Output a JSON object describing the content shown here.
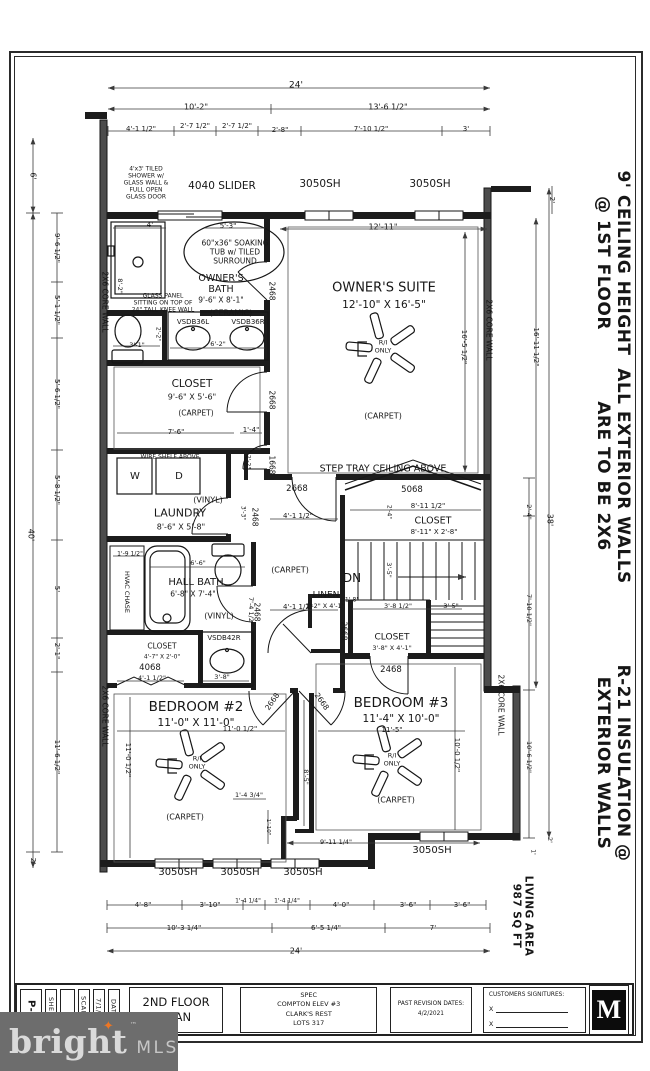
{
  "title_block": {
    "sheet_value": "P-4",
    "sheet_label": "SHEET:",
    "scale_label": "SCALE:",
    "date_value": "7/1/20",
    "date_label": "DATE:",
    "plan_title": "2ND FLOOR\nPLAN",
    "project": "SPEC\nCOMPTON ELEV #3\nCLARK'S REST\nLOTS 317",
    "revision_label": "PAST REVISION DATES:",
    "revision_value": "4/2/2021",
    "signatures_label": "CUSTOMERS SIGNITURES:",
    "sig_mark": "X",
    "logo_letter": "M"
  },
  "watermark": {
    "brand": "bright",
    "tm": "™",
    "suffix": "MLS",
    "star_color": "#ee7623"
  },
  "plan": {
    "labels": [
      {
        "n": "dim-overall-width-top",
        "t": "24'",
        "x": 296,
        "y": 86,
        "s": 9
      },
      {
        "n": "dim-10-2",
        "t": "10'-2\"",
        "x": 196,
        "y": 107,
        "s": 8
      },
      {
        "n": "dim-13-6-half",
        "t": "13'-6 1/2\"",
        "x": 388,
        "y": 107,
        "s": 8
      },
      {
        "n": "dim-4-1-half-top",
        "t": "4'-1 1/2\"",
        "x": 141,
        "y": 129,
        "s": 7
      },
      {
        "n": "dim-2-7-half-a",
        "t": "2'-7 1/2\"",
        "x": 195,
        "y": 126,
        "s": 7
      },
      {
        "n": "dim-2-7-half-b",
        "t": "2'-7 1/2\"",
        "x": 237,
        "y": 126,
        "s": 7
      },
      {
        "n": "dim-2-8",
        "t": "2'-8\"",
        "x": 280,
        "y": 130,
        "s": 7
      },
      {
        "n": "dim-7-10-half-top",
        "t": "7'-10 1/2\"",
        "x": 371,
        "y": 129,
        "s": 7
      },
      {
        "n": "dim-3ft-top",
        "t": "3'",
        "x": 466,
        "y": 129,
        "s": 7
      },
      {
        "n": "window-4040-slider",
        "t": "4040 SLIDER",
        "x": 222,
        "y": 186,
        "s": 10.5
      },
      {
        "n": "window-3050sh-top-a",
        "t": "3050SH",
        "x": 320,
        "y": 184,
        "s": 10.5
      },
      {
        "n": "window-3050sh-top-b",
        "t": "3050SH",
        "x": 430,
        "y": 184,
        "s": 10.5
      },
      {
        "n": "dim-12-11",
        "t": "12'-11\"",
        "x": 383,
        "y": 227,
        "s": 8
      },
      {
        "n": "dim-6ft-left",
        "t": "6'",
        "x": 33,
        "y": 176,
        "s": 8,
        "r": 90
      },
      {
        "n": "dim-9-6-half-left",
        "t": "9'-6 1/2\"",
        "x": 57,
        "y": 248,
        "s": 7,
        "r": 90
      },
      {
        "n": "dim-5-1-half-left",
        "t": "5'-1 1/2\"",
        "x": 57,
        "y": 310,
        "s": 7,
        "r": 90
      },
      {
        "n": "dim-5-6-half-left",
        "t": "5'-6 1/2\"",
        "x": 57,
        "y": 394,
        "s": 7,
        "r": 90
      },
      {
        "n": "dim-5-8-half-left",
        "t": "5'-8 1/2\"",
        "x": 57,
        "y": 490,
        "s": 7,
        "r": 90
      },
      {
        "n": "dim-40ft-left",
        "t": "40'",
        "x": 31,
        "y": 535,
        "s": 8,
        "r": 90
      },
      {
        "n": "dim-5ft-left",
        "t": "5'",
        "x": 57,
        "y": 589,
        "s": 7,
        "r": 90
      },
      {
        "n": "dim-2-1-left",
        "t": "2'-1\"",
        "x": 57,
        "y": 651,
        "s": 7,
        "r": 90
      },
      {
        "n": "dim-11-6-half-left",
        "t": "11'-6 1/2\"",
        "x": 57,
        "y": 757,
        "s": 7,
        "r": 90
      },
      {
        "n": "dim-2ft-left-bottom",
        "t": "2'",
        "x": 33,
        "y": 861,
        "s": 7,
        "r": 90
      },
      {
        "n": "core-wall-left-upper",
        "t": "2X6 CORE WALL",
        "x": 104,
        "y": 302,
        "s": 7.5,
        "r": 90
      },
      {
        "n": "core-wall-left-lower",
        "t": "2X6 CORE WALL",
        "x": 104,
        "y": 716,
        "s": 7.5,
        "r": 90
      },
      {
        "n": "core-wall-right-upper",
        "t": "2X6 CORE WALL",
        "x": 488,
        "y": 330,
        "s": 7.5,
        "r": 90
      },
      {
        "n": "core-wall-right-lower",
        "t": "2X6 CORE WALL",
        "x": 500,
        "y": 705,
        "s": 7.5,
        "r": 90
      },
      {
        "n": "note-tiled-shower",
        "t": "4'x3' TILED\nSHOWER w/\nGLASS WALL &\nFULL OPEN\nGLASS DOOR",
        "x": 146,
        "y": 183,
        "s": 6
      },
      {
        "n": "dim-4ft-shower",
        "t": "4'",
        "x": 150,
        "y": 225,
        "s": 7
      },
      {
        "n": "dim-5-3-tub",
        "t": "5'-3\"",
        "x": 228,
        "y": 226,
        "s": 7
      },
      {
        "n": "note-soaking-tub",
        "t": "60\"x36\" SOAKING\nTUB w/ TILED\nSURROUND",
        "x": 235,
        "y": 253,
        "s": 7.5
      },
      {
        "n": "room-owners-bath",
        "t": "OWNER'S\nBATH",
        "x": 221,
        "y": 284,
        "s": 9.5
      },
      {
        "n": "dim-owners-bath",
        "t": "9'-6\" X 8'-1\"",
        "x": 221,
        "y": 301,
        "s": 7.5
      },
      {
        "n": "finish-owners-bath",
        "t": "(CERAMIC)",
        "x": 231,
        "y": 313,
        "s": 8
      },
      {
        "n": "dim-8-2-shower",
        "t": "8'-2\"",
        "x": 119,
        "y": 286,
        "s": 6.5,
        "r": 90
      },
      {
        "n": "note-glass-panel",
        "t": "GLASS PANEL\nSITTING ON TOP OF\n24\" TALL KNEE WALL",
        "x": 163,
        "y": 303,
        "s": 6
      },
      {
        "n": "door-2468-owners-bath",
        "t": "2468",
        "x": 271,
        "y": 291,
        "s": 7.5,
        "r": 90
      },
      {
        "n": "vanity-vsdb36l",
        "t": "VSDB36L",
        "x": 193,
        "y": 322,
        "s": 7
      },
      {
        "n": "vanity-vsdb36r",
        "t": "VSDB36R",
        "x": 248,
        "y": 322,
        "s": 7
      },
      {
        "n": "dim-2-2-toilet",
        "t": "2'-2\"",
        "x": 158,
        "y": 334,
        "s": 6,
        "r": 90
      },
      {
        "n": "dim-3-1-toilet",
        "t": "3'-1\"",
        "x": 137,
        "y": 346,
        "s": 6.5
      },
      {
        "n": "dim-6-2-vanity",
        "t": "6'-2\"",
        "x": 218,
        "y": 345,
        "s": 6.5
      },
      {
        "n": "room-owners-suite",
        "t": "OWNER'S SUITE",
        "x": 384,
        "y": 288,
        "s": 13
      },
      {
        "n": "dim-owners-suite",
        "t": "12'-10\" X 16'-5\"",
        "x": 384,
        "y": 305,
        "s": 10.5
      },
      {
        "n": "fan-owners-suite-label",
        "t": "R/I\nONLY",
        "x": 383,
        "y": 347,
        "s": 6.5
      },
      {
        "n": "finish-owners-suite",
        "t": "(CARPET)",
        "x": 383,
        "y": 416,
        "s": 8
      },
      {
        "n": "note-step-tray",
        "t": "STEP TRAY CEILING ABOVE",
        "x": 383,
        "y": 469,
        "s": 9.5
      },
      {
        "n": "dim-16-5-half-suite",
        "t": "16'-5 1/2\"",
        "x": 464,
        "y": 347,
        "s": 7,
        "r": 90
      },
      {
        "n": "dim-16-11-half-right",
        "t": "16'-11 1/2\"",
        "x": 536,
        "y": 347,
        "s": 7,
        "r": 90
      },
      {
        "n": "dim-2ft-right-top",
        "t": "2'",
        "x": 552,
        "y": 200,
        "s": 7,
        "r": 90
      },
      {
        "n": "dim-38ft-right",
        "t": "38'",
        "x": 550,
        "y": 520,
        "s": 8,
        "r": 90
      },
      {
        "n": "room-owners-closet",
        "t": "CLOSET",
        "x": 192,
        "y": 384,
        "s": 10.5
      },
      {
        "n": "dim-owners-closet",
        "t": "9'-6\" X 5'-6\"",
        "x": 192,
        "y": 397,
        "s": 8
      },
      {
        "n": "finish-owners-closet",
        "t": "(CARPET)",
        "x": 196,
        "y": 414,
        "s": 7.5
      },
      {
        "n": "dim-7-6-closet",
        "t": "7'-6\"",
        "x": 176,
        "y": 432,
        "s": 7
      },
      {
        "n": "dim-1-4-closet",
        "t": "1'-4\"",
        "x": 251,
        "y": 430,
        "s": 7
      },
      {
        "n": "door-2668-owners-closet",
        "t": "2668",
        "x": 271,
        "y": 400,
        "s": 7.5,
        "r": 90
      },
      {
        "n": "door-1668-hall",
        "t": "1668",
        "x": 271,
        "y": 465,
        "s": 7.5,
        "r": 90
      },
      {
        "n": "dim-2-2-alcove",
        "t": "2'-2\"",
        "x": 248,
        "y": 462,
        "s": 6,
        "r": 90
      },
      {
        "n": "note-wire-shelf",
        "t": "WIRE SHELF ABOVE",
        "x": 170,
        "y": 457,
        "s": 6
      },
      {
        "n": "appliance-washer",
        "t": "W",
        "x": 135,
        "y": 477,
        "s": 10
      },
      {
        "n": "appliance-dryer",
        "t": "D",
        "x": 179,
        "y": 477,
        "s": 10
      },
      {
        "n": "finish-laundry",
        "t": "(VINYL)",
        "x": 208,
        "y": 500,
        "s": 8
      },
      {
        "n": "room-laundry",
        "t": "LAUNDRY",
        "x": 180,
        "y": 514,
        "s": 11
      },
      {
        "n": "dim-laundry",
        "t": "8'-6\" X 5'-8\"",
        "x": 181,
        "y": 527,
        "s": 8
      },
      {
        "n": "door-2468-laundry",
        "t": "2468",
        "x": 254,
        "y": 517,
        "s": 7.5,
        "r": 90
      },
      {
        "n": "dim-3-3-laundry",
        "t": "3'-3\"",
        "x": 243,
        "y": 513,
        "s": 6,
        "r": 90
      },
      {
        "n": "door-2668-suite-entry",
        "t": "2668",
        "x": 297,
        "y": 489,
        "s": 8.5
      },
      {
        "n": "dim-4-1-half-hall-top",
        "t": "4'-1 1/2\"",
        "x": 298,
        "y": 516,
        "s": 7
      },
      {
        "n": "finish-hall",
        "t": "(CARPET)",
        "x": 290,
        "y": 570,
        "s": 8
      },
      {
        "n": "dim-4-1-half-hall-bottom",
        "t": "4'-1 1/2\"",
        "x": 298,
        "y": 607,
        "s": 7
      },
      {
        "n": "dim-7-4-half-hall",
        "t": "7'-4 1/2\"",
        "x": 250,
        "y": 611,
        "s": 6.5,
        "r": 90
      },
      {
        "n": "window-5068",
        "t": "5068",
        "x": 412,
        "y": 490,
        "s": 8.5
      },
      {
        "n": "dim-8-11-half-stairs",
        "t": "8'-11 1/2\"",
        "x": 428,
        "y": 506,
        "s": 7
      },
      {
        "n": "dim-2-4-stairs",
        "t": "2'-4\"",
        "x": 389,
        "y": 512,
        "s": 6,
        "r": 90
      },
      {
        "n": "room-stairs-closet",
        "t": "CLOSET",
        "x": 433,
        "y": 521,
        "s": 9.5
      },
      {
        "n": "dim-stairs-closet",
        "t": "8'-11\" X 2'-8\"",
        "x": 434,
        "y": 532,
        "s": 7
      },
      {
        "n": "stairs-dn",
        "t": "DN",
        "x": 352,
        "y": 578,
        "s": 12
      },
      {
        "n": "dim-3-5-stairs",
        "t": "3'-5\"",
        "x": 388,
        "y": 570,
        "s": 6.5,
        "r": 90
      },
      {
        "n": "room-linen",
        "t": "LINEN",
        "x": 326,
        "y": 596,
        "s": 9
      },
      {
        "n": "dim-linen",
        "t": "1'-2\" X 4'-1\"",
        "x": 325,
        "y": 607,
        "s": 6.5
      },
      {
        "n": "dim-1-8-linen",
        "t": "1'-8\"",
        "x": 352,
        "y": 600,
        "s": 6
      },
      {
        "n": "door-2668-linen",
        "t": "2668",
        "x": 343,
        "y": 631,
        "s": 7.5,
        "r": 90
      },
      {
        "n": "dim-3-8-half-closet3",
        "t": "3'-8 1/2\"",
        "x": 398,
        "y": 607,
        "s": 6.5
      },
      {
        "n": "dim-3-5-closet3",
        "t": "3'-5\"",
        "x": 451,
        "y": 607,
        "s": 6.5
      },
      {
        "n": "room-bedroom3-closet",
        "t": "CLOSET",
        "x": 392,
        "y": 638,
        "s": 9
      },
      {
        "n": "dim-bedroom3-closet",
        "t": "3'-8\" X 4'-1\"",
        "x": 392,
        "y": 649,
        "s": 6.5
      },
      {
        "n": "door-2468-bedroom3-closet",
        "t": "2468",
        "x": 391,
        "y": 670,
        "s": 8.5
      },
      {
        "n": "dim-1-9-half-hvac",
        "t": "1'-9 1/2\"",
        "x": 130,
        "y": 554,
        "s": 6
      },
      {
        "n": "hvac-chase",
        "t": "HVAC CHASE",
        "x": 126,
        "y": 592,
        "s": 6.5,
        "r": 90
      },
      {
        "n": "dim-6-6-hallbath",
        "t": "6'-6\"",
        "x": 198,
        "y": 564,
        "s": 6.5
      },
      {
        "n": "room-hall-bath",
        "t": "HALL BATH",
        "x": 196,
        "y": 583,
        "s": 10
      },
      {
        "n": "dim-hall-bath",
        "t": "6'-8\" X 7'-4\"",
        "x": 193,
        "y": 595,
        "s": 7.5
      },
      {
        "n": "finish-hall-bath",
        "t": "(VINYL)",
        "x": 219,
        "y": 616,
        "s": 8
      },
      {
        "n": "vanity-vsdb42r",
        "t": "VSDB42R",
        "x": 224,
        "y": 638,
        "s": 7
      },
      {
        "n": "door-2468-hall-bath",
        "t": "2468",
        "x": 256,
        "y": 612,
        "s": 7.5,
        "r": 90
      },
      {
        "n": "room-bedroom2-closet",
        "t": "CLOSET",
        "x": 162,
        "y": 647,
        "s": 7.5
      },
      {
        "n": "dim-bedroom2-closet",
        "t": "4'-7\" X 2'-0\"",
        "x": 162,
        "y": 657,
        "s": 6
      },
      {
        "n": "door-4068",
        "t": "4068",
        "x": 150,
        "y": 668,
        "s": 8.5
      },
      {
        "n": "dim-4-1-half-closet2",
        "t": "4'-1 1/2\"",
        "x": 152,
        "y": 679,
        "s": 6.5
      },
      {
        "n": "dim-3-8-closet2",
        "t": "3'-8\"",
        "x": 222,
        "y": 678,
        "s": 6.5
      },
      {
        "n": "room-bedroom2",
        "t": "BEDROOM #2",
        "x": 196,
        "y": 708,
        "s": 13.5
      },
      {
        "n": "dim-bedroom2",
        "t": "11'-0\" X 11'-0\"",
        "x": 196,
        "y": 723,
        "s": 10.5
      },
      {
        "n": "dim-11-0-half-b2",
        "t": "11'-0 1/2\"",
        "x": 240,
        "y": 729,
        "s": 7
      },
      {
        "n": "dim-11-0-half-b2-v",
        "t": "11'-0 1/2\"",
        "x": 128,
        "y": 760,
        "s": 7,
        "r": 90
      },
      {
        "n": "fan-bedroom2-label",
        "t": "R/I\nONLY",
        "x": 197,
        "y": 763,
        "s": 6.5
      },
      {
        "n": "finish-bedroom2",
        "t": "(CARPET)",
        "x": 185,
        "y": 817,
        "s": 8
      },
      {
        "n": "dim-1-4-34",
        "t": "1'-4 3/4\"",
        "x": 249,
        "y": 796,
        "s": 6.5
      },
      {
        "n": "dim-1-10",
        "t": "1'-10\"",
        "x": 268,
        "y": 827,
        "s": 5.5,
        "r": 90
      },
      {
        "n": "dim-8-5",
        "t": "8'-5\"",
        "x": 305,
        "y": 777,
        "s": 6.5,
        "r": 90
      },
      {
        "n": "door-2668-bedroom2",
        "t": "2668",
        "x": 273,
        "y": 702,
        "s": 7.5,
        "r": -55
      },
      {
        "n": "door-2668-bedroom3",
        "t": "2668",
        "x": 321,
        "y": 702,
        "s": 7.5,
        "r": 55
      },
      {
        "n": "room-bedroom3",
        "t": "BEDROOM #3",
        "x": 401,
        "y": 704,
        "s": 13.5
      },
      {
        "n": "dim-bedroom3",
        "t": "11'-4\" X 10'-0\"",
        "x": 401,
        "y": 719,
        "s": 10.5
      },
      {
        "n": "dim-11-5-b3",
        "t": "11'-5\"",
        "x": 392,
        "y": 730,
        "s": 7
      },
      {
        "n": "fan-bedroom3-label",
        "t": "R/I\nONLY",
        "x": 392,
        "y": 760,
        "s": 6.5
      },
      {
        "n": "finish-bedroom3",
        "t": "(CARPET)",
        "x": 396,
        "y": 800,
        "s": 8
      },
      {
        "n": "dim-10-0-half-b3",
        "t": "10'-0 1/2\"",
        "x": 457,
        "y": 755,
        "s": 7,
        "r": 90
      },
      {
        "n": "dim-9-11-quarter",
        "t": "9'-11 1/4\"",
        "x": 336,
        "y": 843,
        "s": 6.5
      },
      {
        "n": "window-3050sh-b3",
        "t": "3050SH",
        "x": 432,
        "y": 851,
        "s": 10
      },
      {
        "n": "dim-2-4-right",
        "t": "2'-4\"",
        "x": 528,
        "y": 512,
        "s": 6.5,
        "r": 90
      },
      {
        "n": "dim-7-10-half-right",
        "t": "7'-10 1/2\"",
        "x": 528,
        "y": 610,
        "s": 6.5,
        "r": 90
      },
      {
        "n": "dim-10-6-half-right",
        "t": "10'-6 1/2\"",
        "x": 528,
        "y": 757,
        "s": 6.5,
        "r": 90
      },
      {
        "n": "dim-2ft-right-bottom",
        "t": "2'",
        "x": 549,
        "y": 840,
        "s": 6.5,
        "r": 90
      },
      {
        "n": "dim-1ft-right-bottom",
        "t": "1'",
        "x": 533,
        "y": 852,
        "s": 6,
        "r": 90
      },
      {
        "n": "window-3050sh-bottom-a",
        "t": "3050SH",
        "x": 178,
        "y": 873,
        "s": 10
      },
      {
        "n": "window-3050sh-bottom-b",
        "t": "3050SH",
        "x": 240,
        "y": 873,
        "s": 10
      },
      {
        "n": "window-3050sh-bottom-c",
        "t": "3050SH",
        "x": 303,
        "y": 873,
        "s": 10
      },
      {
        "n": "dim-4-8",
        "t": "4'-8\"",
        "x": 143,
        "y": 905,
        "s": 7
      },
      {
        "n": "dim-3-10",
        "t": "3'-10\"",
        "x": 210,
        "y": 905,
        "s": 7
      },
      {
        "n": "dim-1-4-quarter-a",
        "t": "1'-4 1/4\"",
        "x": 248,
        "y": 901,
        "s": 6
      },
      {
        "n": "dim-1-4-quarter-b",
        "t": "1'-4 1/4\"",
        "x": 287,
        "y": 901,
        "s": 6
      },
      {
        "n": "dim-4-0",
        "t": "4'-0\"",
        "x": 341,
        "y": 905,
        "s": 7
      },
      {
        "n": "dim-3-6-a",
        "t": "3'-6\"",
        "x": 408,
        "y": 905,
        "s": 7
      },
      {
        "n": "dim-3-6-b",
        "t": "3'-6\"",
        "x": 462,
        "y": 905,
        "s": 7
      },
      {
        "n": "dim-10-3-quarter",
        "t": "10'-3 1/4\"",
        "x": 184,
        "y": 928,
        "s": 7
      },
      {
        "n": "dim-6-5-quarter",
        "t": "6'-5 1/4\"",
        "x": 326,
        "y": 928,
        "s": 7
      },
      {
        "n": "dim-7ft",
        "t": "7'",
        "x": 433,
        "y": 928,
        "s": 7
      },
      {
        "n": "dim-overall-width-bottom",
        "t": "24'",
        "x": 296,
        "y": 951,
        "s": 8
      },
      {
        "n": "note-ceiling-height",
        "t": "9' CEILING HEIGHT\n@ 1ST FLOOR",
        "x": 613,
        "y": 263,
        "s": 17,
        "r": 90,
        "b": 1
      },
      {
        "n": "note-exterior-walls",
        "t": "ALL EXTERIOR WALLS\nARE TO BE 2X6",
        "x": 613,
        "y": 476,
        "s": 17,
        "r": 90,
        "b": 1
      },
      {
        "n": "note-insulation",
        "t": "R-21 INSULATION @\nEXTERIOR WALLS",
        "x": 613,
        "y": 763,
        "s": 17,
        "r": 90,
        "b": 1
      },
      {
        "n": "note-living-area",
        "t": "LIVING AREA\n987 SQ FT",
        "x": 522,
        "y": 916,
        "s": 10.5,
        "r": 90,
        "b": 1
      }
    ]
  }
}
